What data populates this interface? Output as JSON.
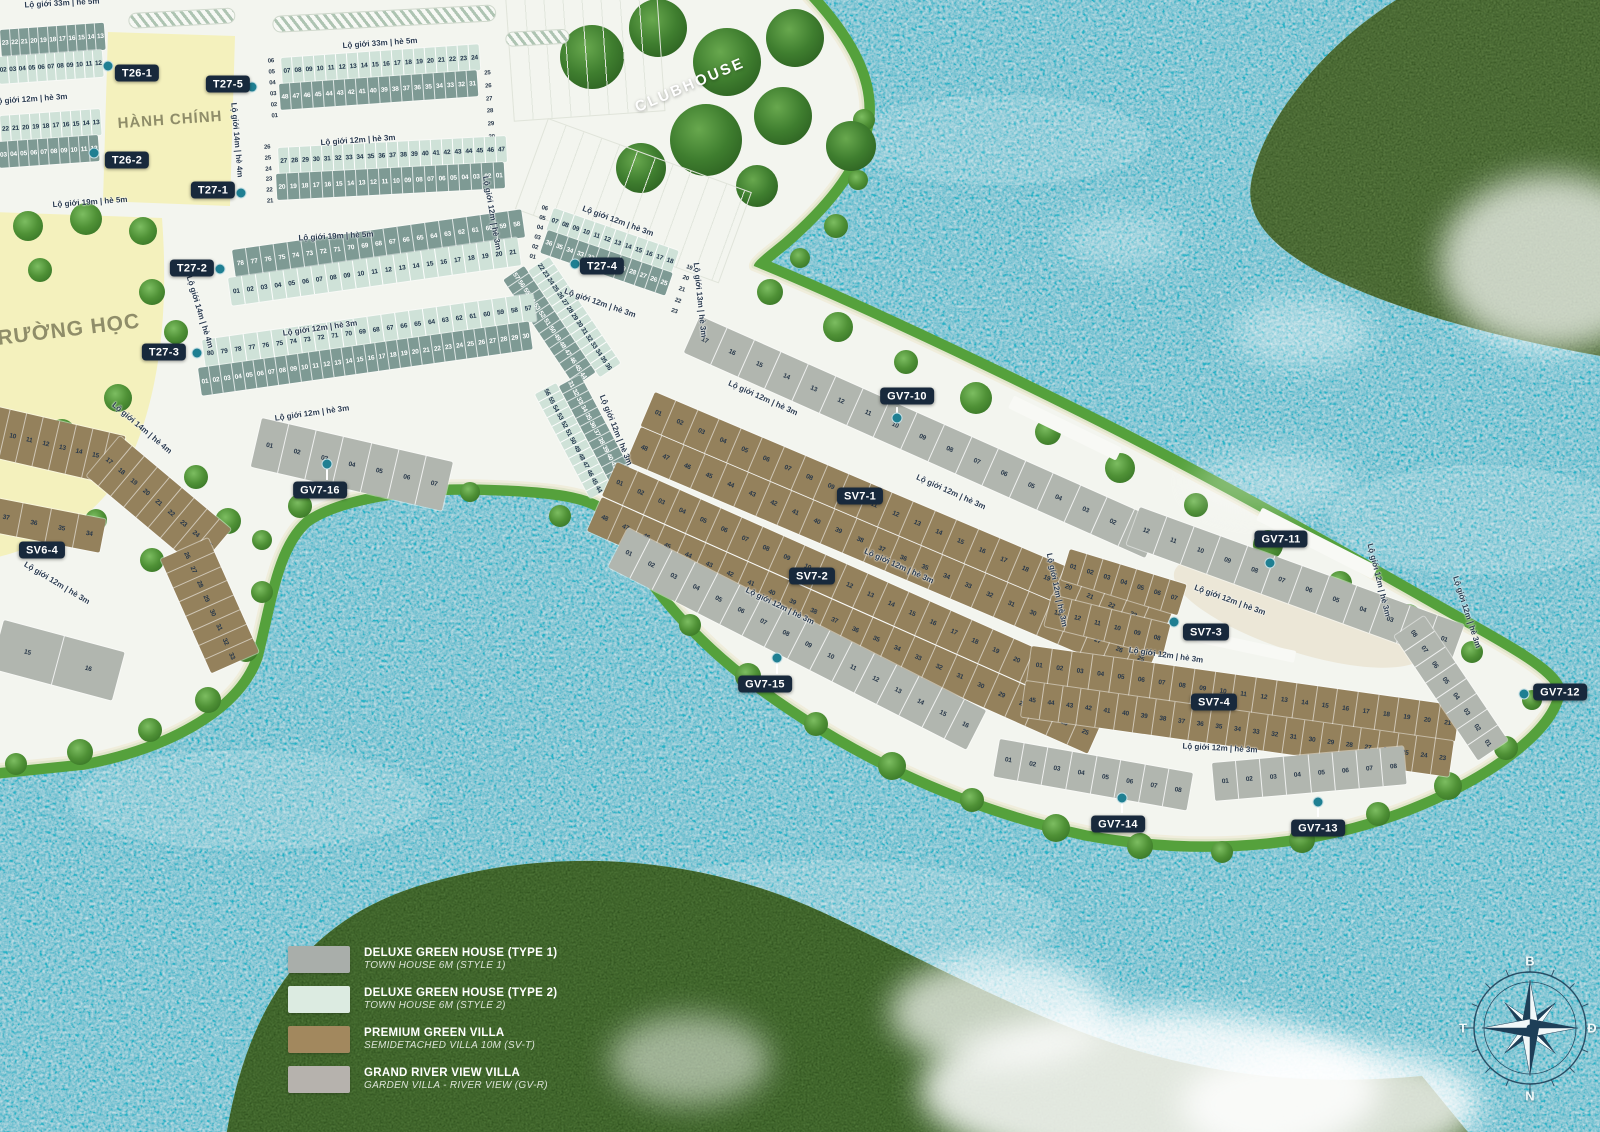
{
  "map": {
    "areas": {
      "admin": "HÀNH CHÍNH",
      "school": "TRƯỜNG HỌC",
      "clubhouse": "CLUBHOUSE"
    },
    "road_labels": {
      "r33": "Lộ giới 33m | hè 5m",
      "r19": "Lộ giới 19m | hè 5m",
      "r14": "Lộ giới 14m | hè 4m",
      "r13": "Lộ giới 13m | hè 3m",
      "r12": "Lộ giới 12m | hè 3m"
    },
    "zones": {
      "t26_1": "T26-1",
      "t26_2": "T26-2",
      "t27_1": "T27-1",
      "t27_2": "T27-2",
      "t27_3": "T27-3",
      "t27_4": "T27-4",
      "t27_5": "T27-5",
      "sv6_4": "SV6-4",
      "sv7_1": "SV7-1",
      "sv7_2": "SV7-2",
      "sv7_3": "SV7-3",
      "sv7_4": "SV7-4",
      "gv7_10": "GV7-10",
      "gv7_11": "GV7-11",
      "gv7_12": "GV7-12",
      "gv7_13": "GV7-13",
      "gv7_14": "GV7-14",
      "gv7_15": "GV7-15",
      "gv7_16": "GV7-16"
    },
    "lot_rows": {
      "t26s1_top": {
        "from": 23,
        "to": 13
      },
      "t26s1_bot": {
        "from": 2,
        "to": 12
      },
      "t26s2_top": {
        "from": 22,
        "to": 13
      },
      "t26s2_bot": {
        "from": 3,
        "to": 12
      },
      "t275_colL": {
        "from": 6,
        "to": 1
      },
      "t275_top": {
        "from": 7,
        "to": 24
      },
      "t275_bot": {
        "from": 48,
        "to": 31
      },
      "t275_colR": {
        "from": 25,
        "to": 30
      },
      "t271_colL": {
        "from": 26,
        "to": 21
      },
      "t271_top": {
        "from": 27,
        "to": 47
      },
      "t271_bot": {
        "from": 20,
        "to": 1
      },
      "t272_top": {
        "from": 78,
        "to": 58
      },
      "t272_bot": {
        "from": 1,
        "to": 21
      },
      "t272_wrap_dark": {
        "from": 57,
        "to": 44
      },
      "t272_wrap_mint": {
        "from": 22,
        "to": 36
      },
      "t273_top": {
        "from": 80,
        "to": 57
      },
      "t273_bot": {
        "from": 1,
        "to": 30
      },
      "t273_wrap_mint": {
        "from": 56,
        "to": 44
      },
      "t273_wrap_dark": {
        "from": 31,
        "to": 43
      },
      "t274_colL": {
        "from": 6,
        "to": 1
      },
      "t274_top": {
        "from": 7,
        "to": 18
      },
      "t274_bot": {
        "from": 36,
        "to": 25
      },
      "t274_colR": {
        "from": 19,
        "to": 23
      },
      "gv716": {
        "from": 1,
        "to": 7
      },
      "sv64_s1": {
        "from": 9,
        "to": 16
      },
      "sv64_s2": {
        "from": 17,
        "to": 25
      },
      "sv64_s3": {
        "from": 26,
        "to": 33
      },
      "sv64_inner": {
        "from": 37,
        "to": 34
      },
      "sv64_gray": {
        "from": 15,
        "to": 16
      },
      "gv710": {
        "from": 17,
        "to": 1
      },
      "sv71_top": {
        "from": 1,
        "to": 24
      },
      "sv71_bot": {
        "from": 48,
        "to": 25
      },
      "sv72_top": {
        "from": 1,
        "to": 24
      },
      "sv72_bot": {
        "from": 48,
        "to": 25
      },
      "gv711": {
        "from": 12,
        "to": 1
      },
      "sv73_top": {
        "from": 1,
        "to": 7
      },
      "sv73_bot": {
        "from": 13,
        "to": 8
      },
      "sv74_top": {
        "from": 1,
        "to": 21
      },
      "sv74_bot": {
        "from": 45,
        "to": 23
      },
      "gv715": {
        "from": 1,
        "to": 16
      },
      "gv714": {
        "from": 1,
        "to": 8
      },
      "gv713": {
        "from": 1,
        "to": 8
      },
      "gv712_tip": {
        "from": 8,
        "to": 1
      }
    },
    "legend": [
      {
        "swatch": "#a9aeaa",
        "title": "DELUXE GREEN HOUSE (TYPE 1)",
        "subtitle": "TOWN HOUSE 6M (STYLE 1)"
      },
      {
        "swatch": "#dcebe1",
        "title": "DELUXE GREEN HOUSE (TYPE 2)",
        "subtitle": "TOWN HOUSE 6M (STYLE 2)"
      },
      {
        "swatch": "#a2885e",
        "title": "PREMIUM GREEN VILLA",
        "subtitle": "SEMIDETACHED VILLA 10M (SV-T)"
      },
      {
        "swatch": "#b6b2ad",
        "title": "GRAND RIVER VIEW VILLA",
        "subtitle": "GARDEN VILLA - RIVER VIEW (GV-R)"
      }
    ],
    "compass": {
      "north": "B",
      "east": "Đ",
      "south": "N",
      "west": "T"
    },
    "colors": {
      "water": "#23b2c6",
      "plan_land": "#f3f5ef",
      "town_dark": "#7e9a94",
      "town_mint": "#cfe2d8",
      "villa_brown": "#94815c",
      "gv_gray": "#b1b6af",
      "zone_yellow": "#f4f1bd",
      "badge_navy": "#18293c",
      "shore_green": "#55a13c",
      "island_green": "#5b7c41",
      "dot_teal": "#1f7f92"
    }
  }
}
